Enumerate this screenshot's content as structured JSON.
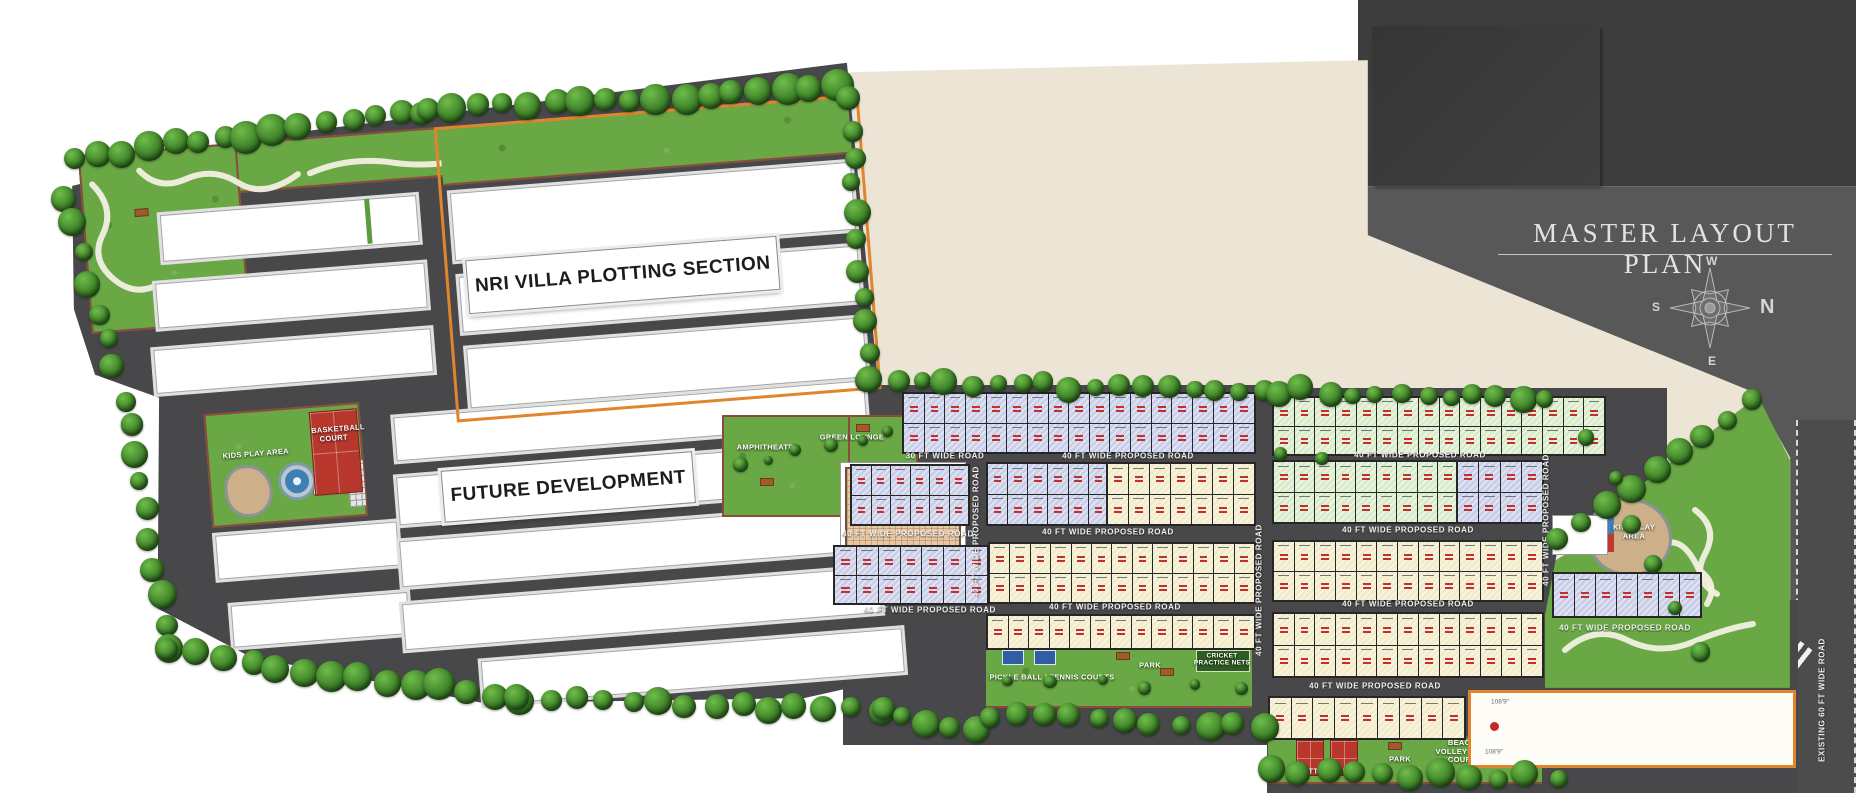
{
  "header": {
    "title": "MASTER LAYOUT PLAN"
  },
  "compass": {
    "top": "W",
    "right": "N",
    "bottom": "E",
    "left": "S"
  },
  "zones": {
    "nri_villa": "NRI VILLA PLOTTING SECTION",
    "future_dev": "FUTURE DEVELOPMENT"
  },
  "amenities": {
    "kids_play_left": "KIDS PLAY AREA",
    "basketball": "BASKETBALL COURT",
    "water_fountain": "WATER FOUNTAIN",
    "amphitheater": "AMPHITHEATER",
    "green_lounge": "GREEN LOUNGE",
    "club_house": "CLUB HOUSE",
    "pickle_ball": "PICKLE BALL / TENNIS COURTS",
    "park_mid": "PARK",
    "cricket_nets": "CRICKET PRACTICE NETS",
    "shuttle_courts": "SHUTTLE COURTS",
    "park_bottom": "PARK",
    "beach_volleyball": "BEACH VOLLEYBALL COURT",
    "kids_play_right": "KIDS PLAY AREA"
  },
  "roads": {
    "ft30": "30 FT WIDE ROAD",
    "ft40": "40 FT WIDE PROPOSED ROAD",
    "existing60": "EXISTING 60 FT WIDE ROAD"
  },
  "annotations": {
    "block_dimension": "108'9\""
  },
  "colors": {
    "panel_gray": "#585858",
    "panel_band": "#3d3d3d",
    "beige_land": "#ece5d6",
    "road_asphalt": "#48484a",
    "accent_orange": "#e0852e",
    "park_green": "#69a844",
    "plot_blue": "#c9cfe8",
    "plot_cream": "#f2ecca",
    "plot_green": "#d9ecca",
    "plot_number_red": "#c12f2f",
    "court_red": "#b8372c",
    "maroon_edge": "#8d4a3e"
  }
}
